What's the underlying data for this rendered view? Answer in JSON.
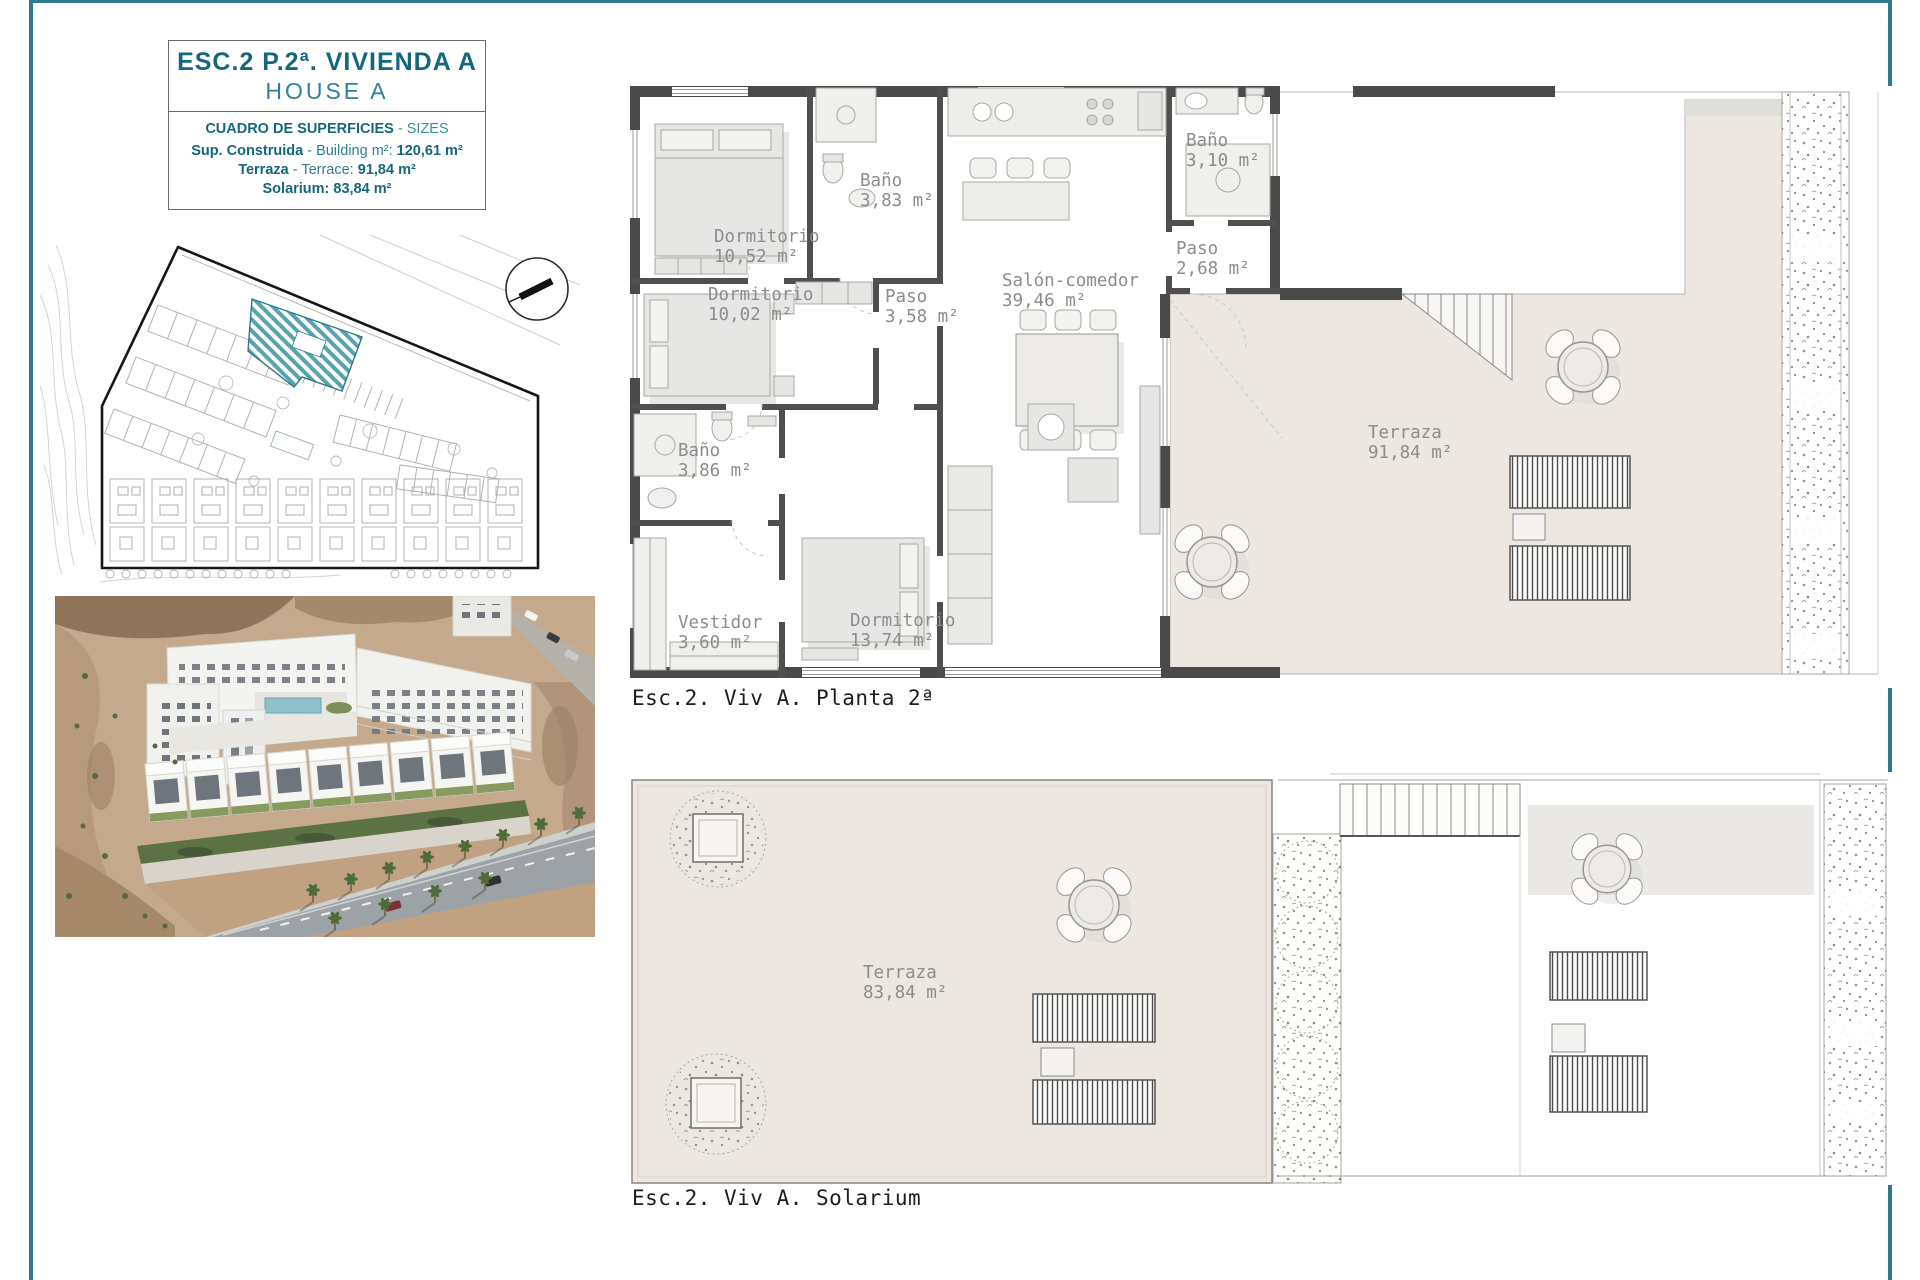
{
  "colors": {
    "accent_teal": "#15677e",
    "page_border_teal": "#2d7c8e",
    "highlight_hatch_teal": "#4a9aa8",
    "terrace_beige": "#ece7e1",
    "wall_gray": "#4a4a4a",
    "room_label_gray": "#8c8c8c"
  },
  "title_block": {
    "title": "ESC.2 P.2ª. VIVIENDA A",
    "subtitle": "HOUSE A",
    "table_heading": "CUADRO DE SUPERFICIES",
    "table_heading_suffix": "- SIZES",
    "rows": [
      {
        "label": "Sup. Construida",
        "mid": "- Building m²:",
        "value": "120,61 m²"
      },
      {
        "label": "Terraza",
        "mid": "- Terrace:",
        "value": "91,84 m²"
      },
      {
        "label": "Solarium:",
        "mid": "",
        "value": "83,84 m²"
      }
    ]
  },
  "plan1": {
    "caption": "Esc.2. Viv A. Planta 2ª",
    "rooms": [
      {
        "name": "Dormitorio",
        "area": "10,52 m²"
      },
      {
        "name": "Baño",
        "area": "3,83 m²"
      },
      {
        "name": "Dormitorio",
        "area": "10,02 m²"
      },
      {
        "name": "Paso",
        "area": "3,58 m²"
      },
      {
        "name": "Salón-comedor",
        "area": "39,46 m²"
      },
      {
        "name": "Baño",
        "area": "3,10 m²"
      },
      {
        "name": "Paso",
        "area": "2,68 m²"
      },
      {
        "name": "Baño",
        "area": "3,86 m²"
      },
      {
        "name": "Vestidor",
        "area": "3,60 m²"
      },
      {
        "name": "Dormitorio",
        "area": "13,74 m²"
      },
      {
        "name": "Terraza",
        "area": "91,84 m²"
      }
    ]
  },
  "plan2": {
    "caption": "Esc.2. Viv A. Solarium",
    "rooms": [
      {
        "name": "Terraza",
        "area": "83,84 m²"
      }
    ]
  }
}
